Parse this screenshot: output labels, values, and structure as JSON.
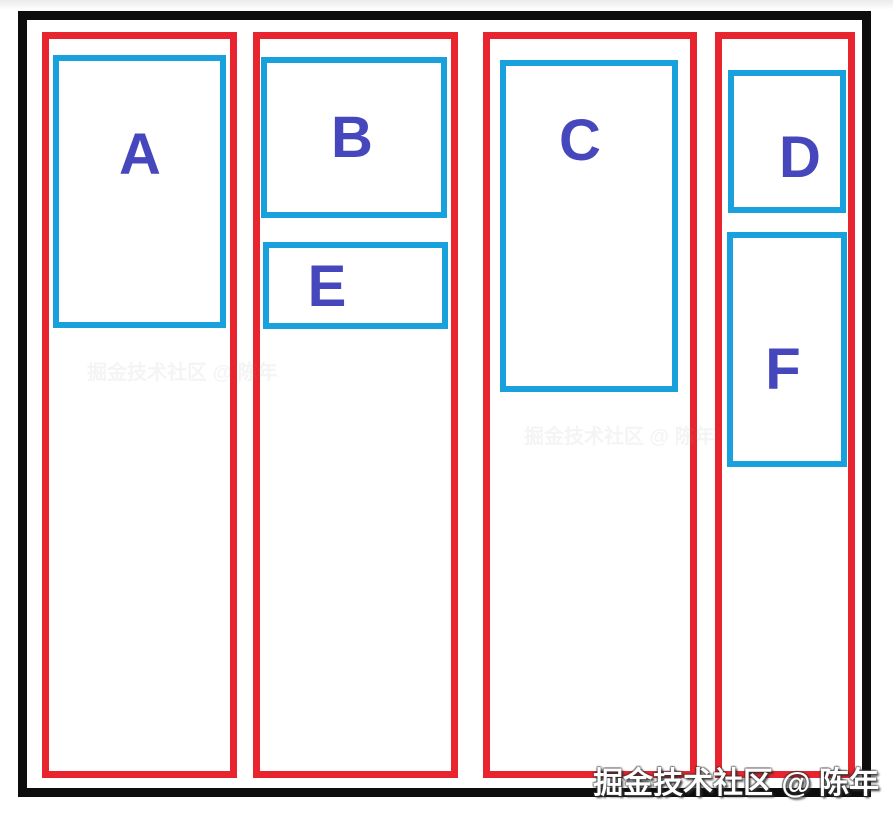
{
  "colors": {
    "frame-border": "#0d0d0d",
    "column-border": "#e8252e",
    "item-border": "#18a1dc",
    "label-text": "#4747bd",
    "watermark-text": "#ffffff"
  },
  "columns": [
    {
      "name": "column-1",
      "items": [
        {
          "label": "A"
        }
      ]
    },
    {
      "name": "column-2",
      "items": [
        {
          "label": "B"
        },
        {
          "label": "E"
        }
      ]
    },
    {
      "name": "column-3",
      "items": [
        {
          "label": "C"
        }
      ]
    },
    {
      "name": "column-4",
      "items": [
        {
          "label": "D"
        },
        {
          "label": "F"
        }
      ]
    }
  ],
  "watermark": {
    "text": "掘金技术社区 @ 陈年"
  }
}
